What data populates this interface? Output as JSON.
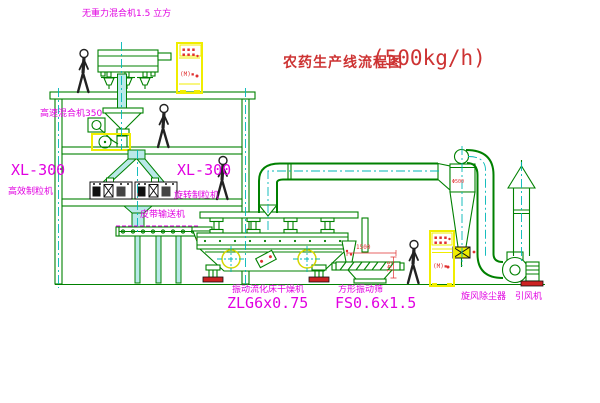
{
  "title": {
    "main": "农药生产线流程图",
    "capacity": "(500kg/h)"
  },
  "equipment_labels": {
    "top_mixer": "无重力混合机1.5 立方",
    "high_speed_mixer": "高速混合机350",
    "granulator_left": {
      "model": "XL-300",
      "name": "高效制粒机"
    },
    "granulator_right": {
      "model": "XL-300",
      "name": "旋转制粒机"
    },
    "belt_conveyor": "皮带输送机",
    "fluid_bed_dryer": {
      "name": "振动流化床干燥机",
      "model": "ZLG6x0.75"
    },
    "square_sieve": {
      "name": "方形振动筛",
      "model": "FS0.6x1.5"
    },
    "cyclone": "旋风除尘器",
    "induced_draft_fan": "引风机"
  },
  "dimensions": {
    "sieve_length": "1500",
    "sieve_height": "541",
    "cyclone_dia": "Φ500"
  },
  "control_cabinets": {
    "top_marks": "▪▪▪",
    "indicator": "(M)▪"
  },
  "colors": {
    "line_green": "#008000",
    "centerline_cyan": "#00b7b7",
    "duct_fill": "#b9e9e9",
    "label_magenta": "#e100e1",
    "title_red": "#cd3333",
    "cabinet_yellow": "#f0ed00",
    "mark_red": "#e03030"
  }
}
